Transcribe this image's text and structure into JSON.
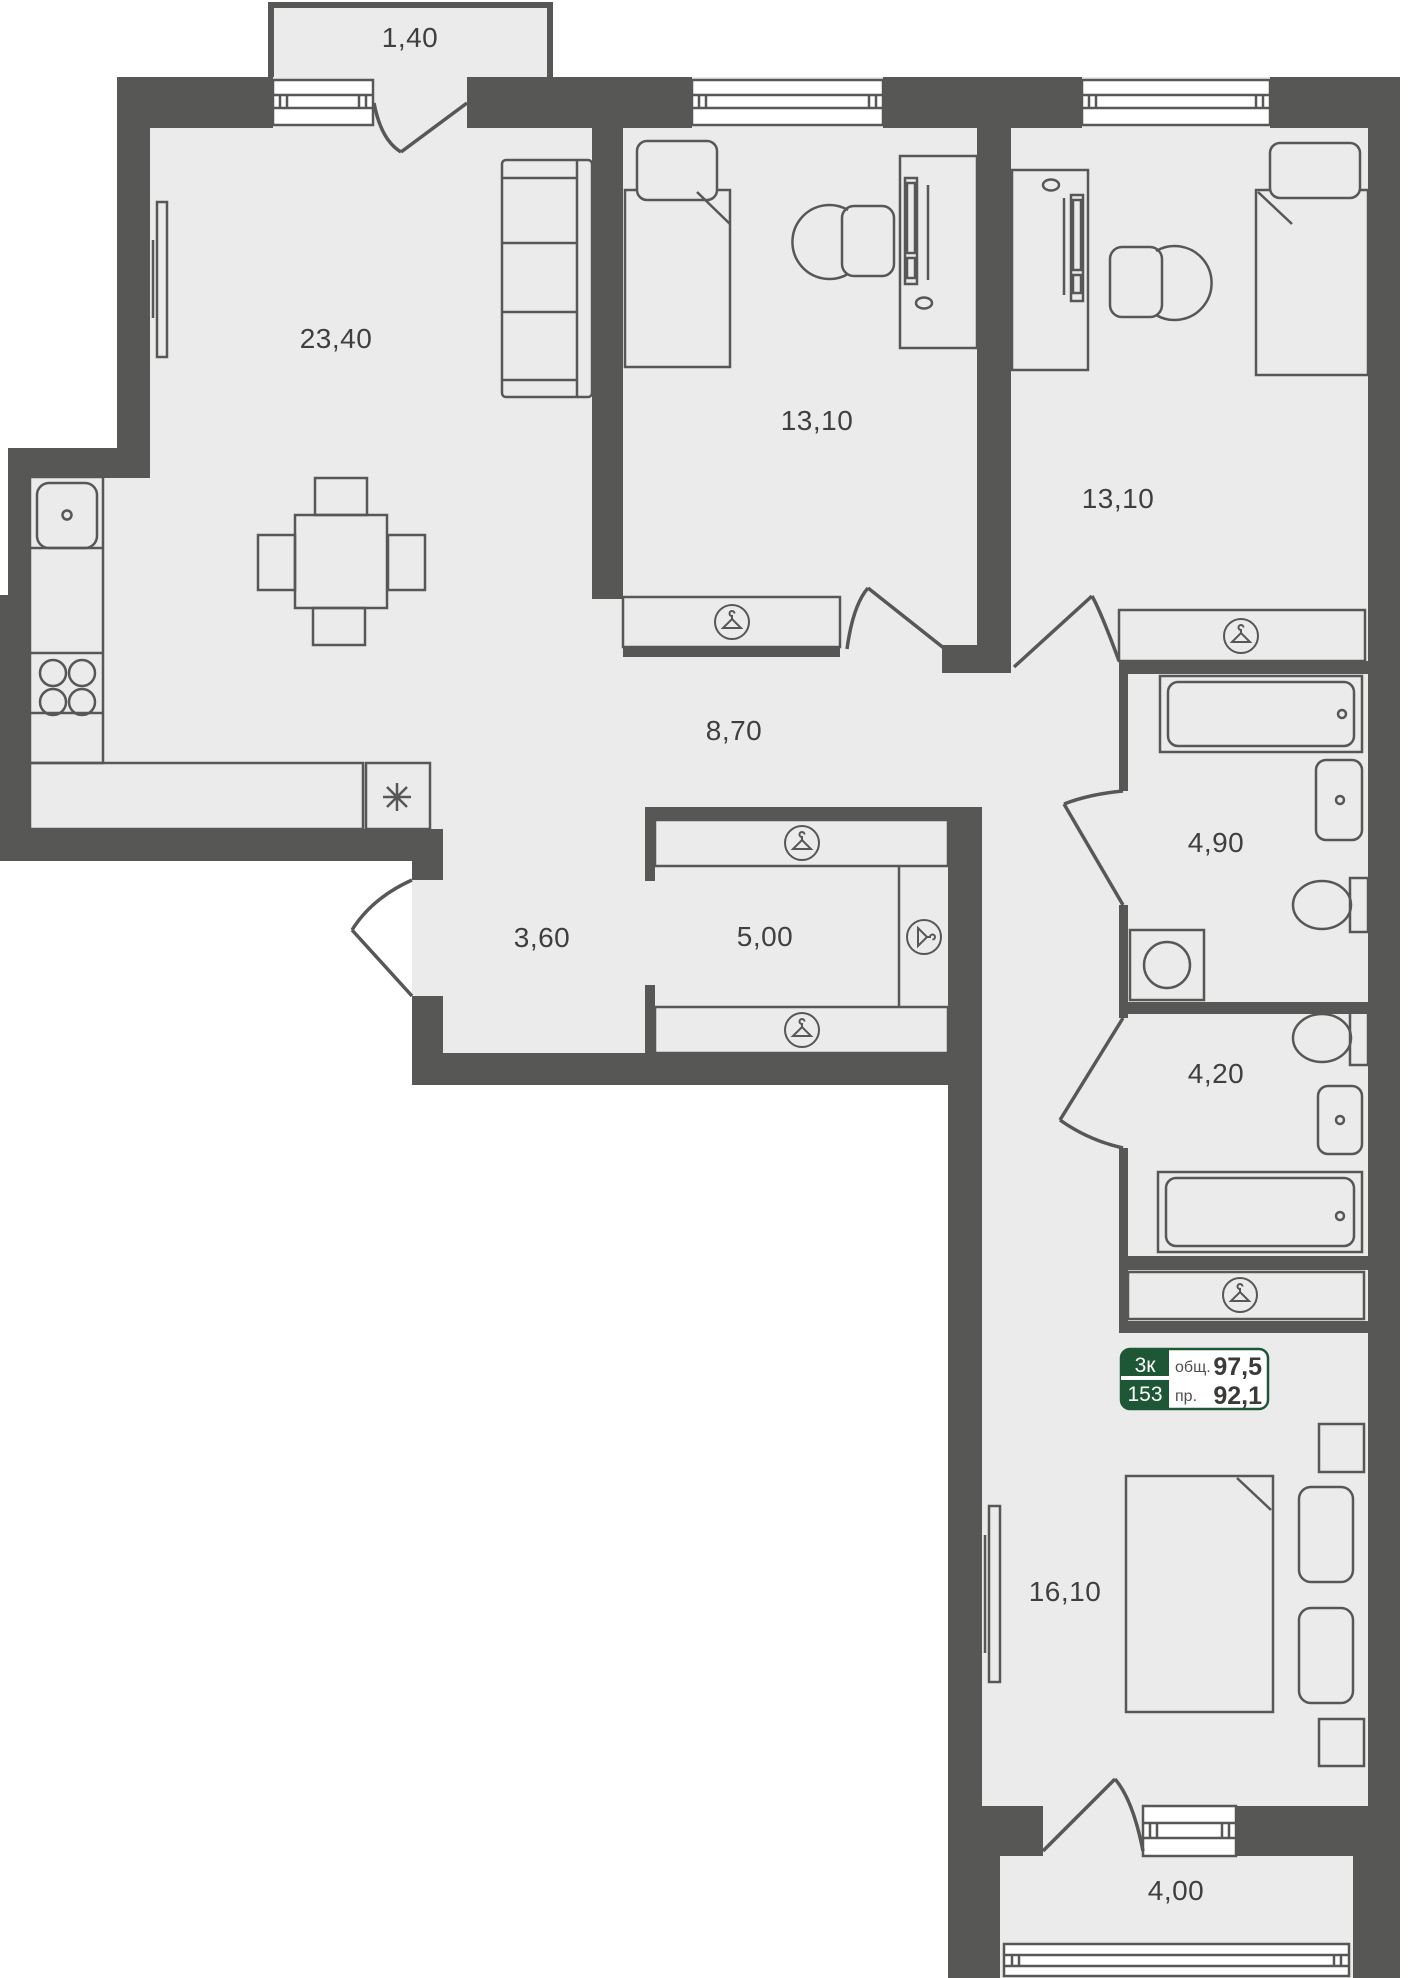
{
  "plan_title": "apartment-floor-plan",
  "badge": {
    "type": "3к",
    "number": "153",
    "total_label": "общ.",
    "total_value": "97,5",
    "reduced_label": "пр.",
    "reduced_value": "92,1"
  },
  "rooms": {
    "balcony_top": {
      "area": "1,40"
    },
    "living_kitchen": {
      "area": "23,40"
    },
    "bedroom_left": {
      "area": "13,10"
    },
    "bedroom_mid": {
      "area": "13,10"
    },
    "hall": {
      "area": "8,70"
    },
    "bathroom_top": {
      "area": "4,90"
    },
    "corridor": {
      "area": "3,60"
    },
    "wardrobe": {
      "area": "5,00"
    },
    "bathroom_low": {
      "area": "4,20"
    },
    "bedroom_master": {
      "area": "16,10"
    },
    "balcony_bottom": {
      "area": "4,00"
    }
  },
  "colors": {
    "wall": "#575756",
    "floor": "#ebebeb",
    "badge_green": "#1e5735",
    "label_text": "#3f3f3e"
  }
}
